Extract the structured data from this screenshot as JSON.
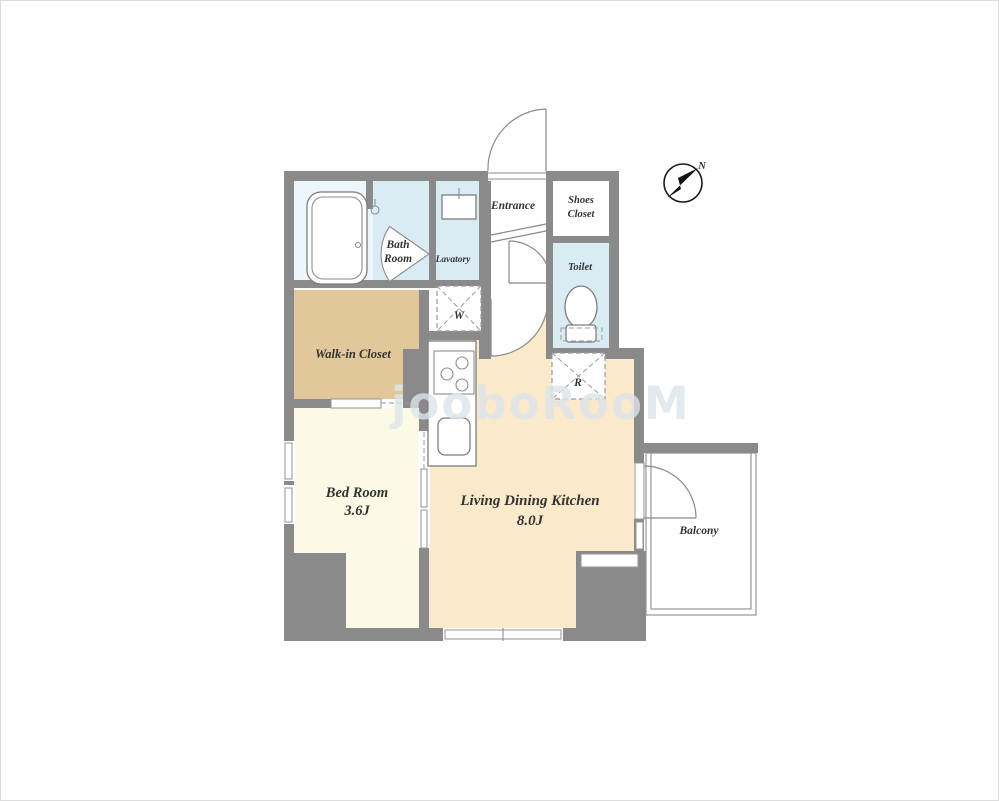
{
  "floorplan": {
    "rooms": {
      "bath": {
        "line1": "Bath",
        "line2": "Room"
      },
      "lavatory": {
        "label": "Lavatory"
      },
      "entrance": {
        "label": "Entrance"
      },
      "shoes_closet": {
        "line1": "Shoes",
        "line2": "Closet"
      },
      "toilet": {
        "label": "Toilet"
      },
      "washer": {
        "label": "W"
      },
      "refrigerator": {
        "label": "R"
      },
      "walk_in_closet": {
        "label": "Walk-in Closet"
      },
      "bedroom": {
        "label": "Bed Room",
        "size": "3.6J"
      },
      "ldk": {
        "label": "Living Dining Kitchen",
        "size": "8.0J"
      },
      "balcony": {
        "label": "Balcony"
      }
    },
    "compass": {
      "label": "N"
    },
    "watermark": {
      "text": "jooboRooM"
    },
    "colors": {
      "wall": "#8a8a8a",
      "wet_area": "#d9ecf4",
      "bath_unit": "#edf6fa",
      "closet": "#e2c79a",
      "bedroom": "#fcfae6",
      "ldk": "#fbe9cb"
    }
  }
}
